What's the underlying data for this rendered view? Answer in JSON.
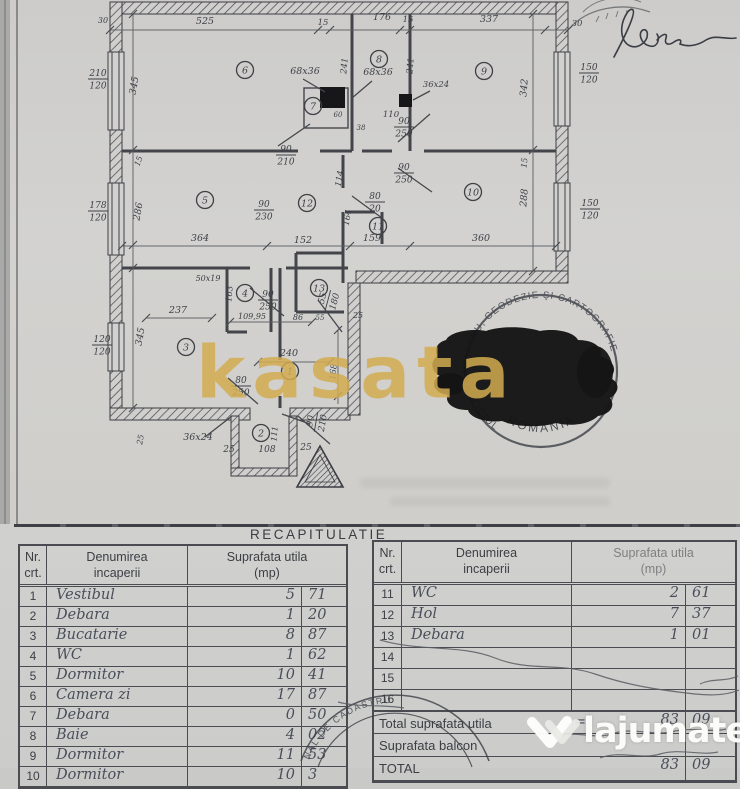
{
  "watermarks": {
    "center_text": "kasata",
    "brand_text": "lajumate",
    "brand_tld": ".ro"
  },
  "stamps": {
    "round_stamp": {
      "arc": "CADASTRU, GEODEZIE ŞI CARTOGRAFIE",
      "left_arc": "OFICIUL",
      "bottom": "ROMÂNIA"
    },
    "partial_stamp_bottom": {
      "arc": "NAL DE CADASTRU"
    }
  },
  "plan": {
    "rooms": [
      {
        "n": "1",
        "x": 290,
        "y": 371
      },
      {
        "n": "2",
        "x": 261,
        "y": 433
      },
      {
        "n": "3",
        "x": 186,
        "y": 347
      },
      {
        "n": "4",
        "x": 245,
        "y": 293
      },
      {
        "n": "5",
        "x": 205,
        "y": 200
      },
      {
        "n": "6",
        "x": 245,
        "y": 70
      },
      {
        "n": "7",
        "x": 313,
        "y": 106
      },
      {
        "n": "8",
        "x": 379,
        "y": 59
      },
      {
        "n": "9",
        "x": 484,
        "y": 71
      },
      {
        "n": "10",
        "x": 473,
        "y": 192
      },
      {
        "n": "11",
        "x": 378,
        "y": 226
      },
      {
        "n": "12",
        "x": 307,
        "y": 203
      },
      {
        "n": "13",
        "x": 319,
        "y": 288
      }
    ],
    "labels": [
      {
        "t": "30",
        "x": 103,
        "y": 23,
        "s": 8
      },
      {
        "t": "525",
        "x": 205,
        "y": 24
      },
      {
        "t": "15",
        "x": 323,
        "y": 25,
        "s": 8.5
      },
      {
        "t": "176",
        "x": 382,
        "y": 20
      },
      {
        "t": "15",
        "x": 408,
        "y": 22,
        "s": 8.5
      },
      {
        "t": "337",
        "x": 489,
        "y": 22
      },
      {
        "t": "30",
        "x": 577,
        "y": 26,
        "s": 8.5
      },
      {
        "t": "345",
        "x": 137,
        "y": 86,
        "r": -80
      },
      {
        "t": "15",
        "x": 141,
        "y": 162,
        "r": -70,
        "s": 8
      },
      {
        "t": "286",
        "x": 141,
        "y": 212,
        "r": -80
      },
      {
        "t": "345",
        "x": 143,
        "y": 337,
        "r": -80
      },
      {
        "t": "342",
        "x": 527,
        "y": 88,
        "r": -85
      },
      {
        "t": "15",
        "x": 527,
        "y": 163,
        "r": -85,
        "s": 8
      },
      {
        "t": "288",
        "x": 527,
        "y": 198,
        "r": -85
      },
      {
        "t": "241",
        "x": 347,
        "y": 66,
        "r": -85,
        "s": 8.5
      },
      {
        "t": "241",
        "x": 413,
        "y": 66,
        "r": -85,
        "s": 8.5
      },
      {
        "t": "68x36",
        "x": 305,
        "y": 74
      },
      {
        "t": "68x36",
        "x": 378,
        "y": 75
      },
      {
        "t": "36x24",
        "x": 436,
        "y": 87,
        "s": 8.5
      },
      {
        "t": "110",
        "x": 391,
        "y": 117,
        "s": 8.5
      },
      {
        "t": "60",
        "x": 338,
        "y": 117,
        "s": 7
      },
      {
        "t": "38",
        "x": 361,
        "y": 130,
        "s": 7
      },
      {
        "t": "114",
        "x": 342,
        "y": 179,
        "r": -80,
        "s": 8.5
      },
      {
        "t": "164",
        "x": 350,
        "y": 218,
        "r": -80,
        "s": 8.5
      },
      {
        "t": "364",
        "x": 200,
        "y": 241
      },
      {
        "t": "152",
        "x": 303,
        "y": 243
      },
      {
        "t": "159",
        "x": 372,
        "y": 241
      },
      {
        "t": "360",
        "x": 481,
        "y": 241
      },
      {
        "t": "237",
        "x": 178,
        "y": 313
      },
      {
        "t": "163",
        "x": 232,
        "y": 294,
        "r": -85,
        "s": 8.5
      },
      {
        "t": "50x19",
        "x": 208,
        "y": 281,
        "s": 8
      },
      {
        "t": "109,95",
        "x": 252,
        "y": 319,
        "s": 8
      },
      {
        "t": "86",
        "x": 298,
        "y": 320,
        "s": 8
      },
      {
        "t": "55",
        "x": 320,
        "y": 320,
        "s": 7
      },
      {
        "t": "25",
        "x": 358,
        "y": 318,
        "s": 8
      },
      {
        "t": "240",
        "x": 289,
        "y": 356
      },
      {
        "t": "168",
        "x": 336,
        "y": 372,
        "r": -85,
        "s": 8.5
      },
      {
        "t": "36x24",
        "x": 198,
        "y": 440
      },
      {
        "t": "25",
        "x": 143,
        "y": 440,
        "r": -80,
        "s": 8
      },
      {
        "t": "111",
        "x": 277,
        "y": 434,
        "r": -85,
        "s": 8
      },
      {
        "t": "25",
        "x": 229,
        "y": 452,
        "s": 9
      },
      {
        "t": "108",
        "x": 267,
        "y": 452,
        "s": 9
      },
      {
        "t": "25",
        "x": 306,
        "y": 450,
        "s": 9
      }
    ],
    "fractions": [
      {
        "a": "210",
        "b": "120",
        "x": 98,
        "y": 76
      },
      {
        "a": "178",
        "b": "120",
        "x": 98,
        "y": 208
      },
      {
        "a": "120",
        "b": "120",
        "x": 102,
        "y": 342
      },
      {
        "a": "150",
        "b": "120",
        "x": 589,
        "y": 70
      },
      {
        "a": "150",
        "b": "120",
        "x": 590,
        "y": 206
      },
      {
        "a": "90",
        "b": "210",
        "x": 286,
        "y": 152
      },
      {
        "a": "90",
        "b": "250",
        "x": 404,
        "y": 124
      },
      {
        "a": "90",
        "b": "250",
        "x": 404,
        "y": 170
      },
      {
        "a": "80",
        "b": "20",
        "x": 375,
        "y": 199
      },
      {
        "a": "90",
        "b": "230",
        "x": 264,
        "y": 207
      },
      {
        "a": "90",
        "b": "250",
        "x": 268,
        "y": 297
      },
      {
        "a": "80",
        "b": "250",
        "x": 241,
        "y": 383
      },
      {
        "a": "90",
        "b": "210",
        "x": 317,
        "y": 418,
        "r": -80
      },
      {
        "a": "55",
        "b": "180",
        "x": 329,
        "y": 296,
        "r": -75
      }
    ]
  },
  "recap": {
    "title": "RECAPITULATIE",
    "header": {
      "nr_l1": "Nr.",
      "nr_l2": "crt.",
      "name_l1": "Denumirea",
      "name_l2": "incaperii",
      "area_l1": "Suprafata utila",
      "area_l2": "(mp)"
    },
    "left_rows": [
      {
        "nr": "1",
        "name": "Vestibul",
        "i": "5",
        "d": "71"
      },
      {
        "nr": "2",
        "name": "Debara",
        "i": "1",
        "d": "20"
      },
      {
        "nr": "3",
        "name": "Bucatarie",
        "i": "8",
        "d": "87"
      },
      {
        "nr": "4",
        "name": "WC",
        "i": "1",
        "d": "62"
      },
      {
        "nr": "5",
        "name": "Dormitor",
        "i": "10",
        "d": "41"
      },
      {
        "nr": "6",
        "name": "Camera zi",
        "i": "17",
        "d": "87"
      },
      {
        "nr": "7",
        "name": "Debara",
        "i": "0",
        "d": "50"
      },
      {
        "nr": "8",
        "name": "Baie",
        "i": "4",
        "d": "02"
      },
      {
        "nr": "9",
        "name": "Dormitor",
        "i": "11",
        "d": "53"
      },
      {
        "nr": "10",
        "name": "Dormitor",
        "i": "10",
        "d": "3"
      }
    ],
    "right_rows": [
      {
        "nr": "11",
        "name": "WC",
        "i": "2",
        "d": "61"
      },
      {
        "nr": "12",
        "name": "Hol",
        "i": "7",
        "d": "37"
      },
      {
        "nr": "13",
        "name": "Debara",
        "i": "1",
        "d": "01"
      },
      {
        "nr": "14",
        "name": "",
        "i": "",
        "d": ""
      },
      {
        "nr": "15",
        "name": "",
        "i": "",
        "d": ""
      },
      {
        "nr": "16",
        "name": "",
        "i": "",
        "d": ""
      }
    ],
    "totals": {
      "row1_label": "Total suprafata utila",
      "row1_eq": "=",
      "row1_int": "83",
      "row1_dec": "09",
      "row2_label": "Suprafata balcon",
      "row3_label": "TOTAL",
      "row3_int": "83",
      "row3_dec": "09"
    }
  },
  "colors": {
    "gold": "#d2ab50",
    "orange": "#f5a100",
    "ink": "#4a4c52",
    "paper": "#cdccca"
  }
}
